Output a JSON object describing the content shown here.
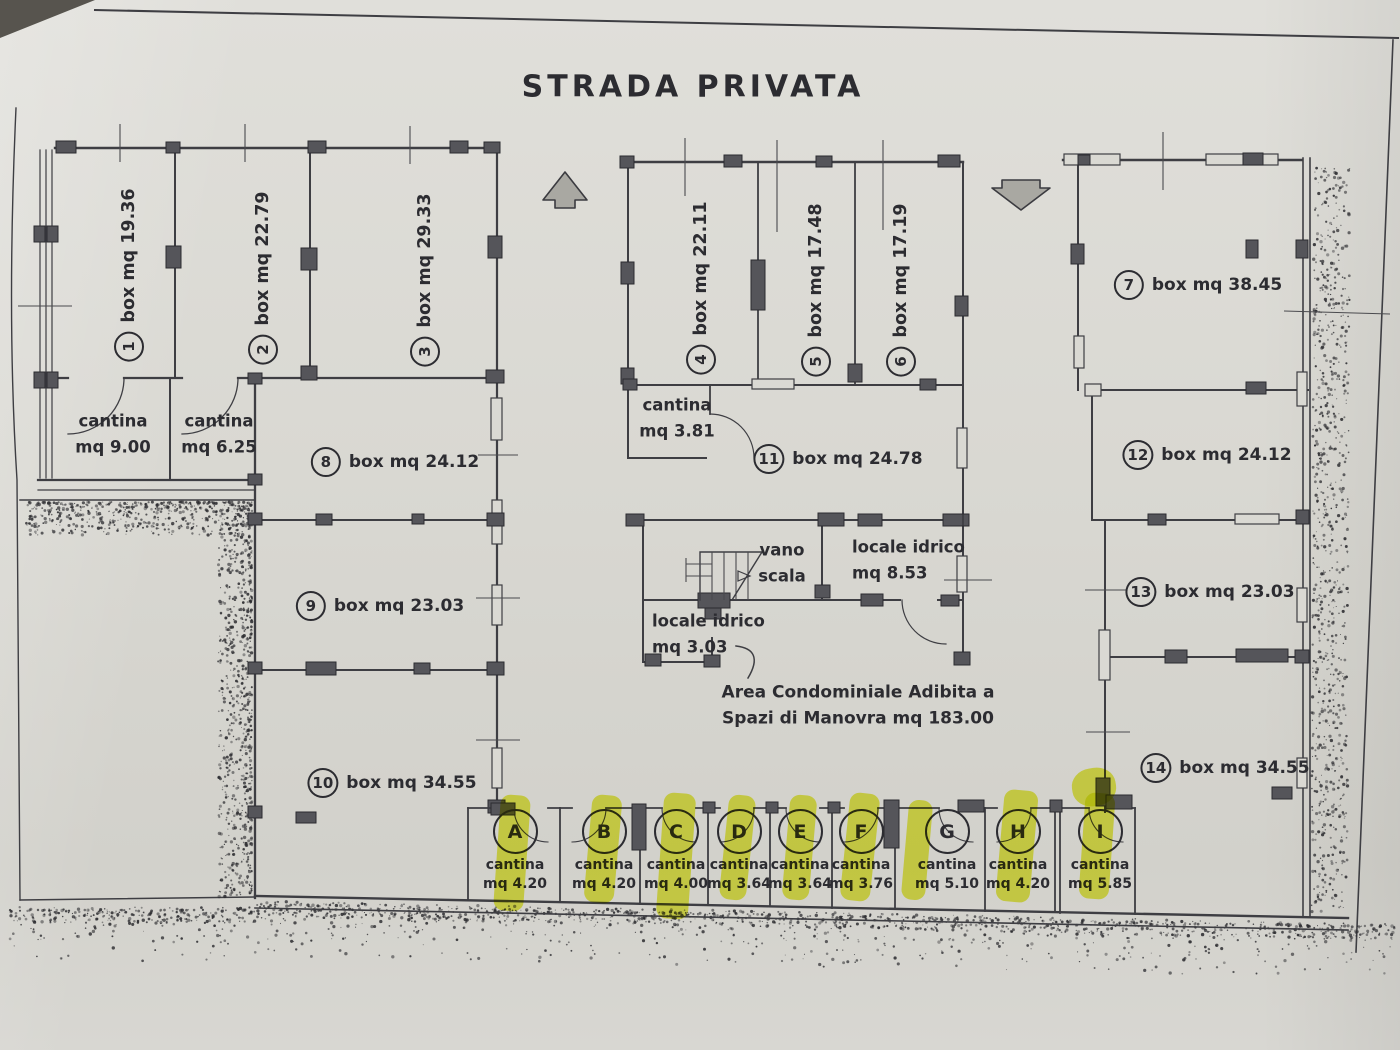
{
  "title": "STRADA PRIVATA",
  "left_wing": {
    "box1": {
      "num": "1",
      "label": "box mq 19.36"
    },
    "box2": {
      "num": "2",
      "label": "box mq 22.79"
    },
    "box3": {
      "num": "3",
      "label": "box mq 29.33"
    },
    "cantina_a": {
      "line1": "cantina",
      "line2": "mq 9.00"
    },
    "cantina_b": {
      "line1": "cantina",
      "line2": "mq 6.25"
    },
    "box8": {
      "num": "8",
      "label": "box mq 24.12"
    },
    "box9": {
      "num": "9",
      "label": "box mq 23.03"
    },
    "box10": {
      "num": "10",
      "label": "box mq 34.55"
    }
  },
  "center_wing": {
    "box4": {
      "num": "4",
      "label": "box mq 22.11"
    },
    "box5": {
      "num": "5",
      "label": "box mq 17.48"
    },
    "box6": {
      "num": "6",
      "label": "box mq 17.19"
    },
    "cantina": {
      "line1": "cantina",
      "line2": "mq 3.81"
    },
    "box11": {
      "num": "11",
      "label": "box mq 24.78"
    },
    "vano_scala": {
      "line1": "vano",
      "line2": "scala"
    },
    "locale_idrico_1": {
      "line1": "locale idrico",
      "line2": "mq 8.53"
    },
    "locale_idrico_2": {
      "line1": "locale idrico",
      "line2": "mq 3.03"
    },
    "area_note": {
      "line1": "Area Condominiale Adibita a",
      "line2": "Spazi di Manovra mq 183.00"
    }
  },
  "right_wing": {
    "box7": {
      "num": "7",
      "label": "box mq 38.45"
    },
    "box12": {
      "num": "12",
      "label": "box mq 24.12"
    },
    "box13": {
      "num": "13",
      "label": "box mq 23.03"
    },
    "box14": {
      "num": "14",
      "label": "box mq 34.55"
    }
  },
  "cellars": [
    {
      "letter": "A",
      "line1": "cantina",
      "line2": "mq 4.20"
    },
    {
      "letter": "B",
      "line1": "cantina",
      "line2": "mq 4.20"
    },
    {
      "letter": "C",
      "line1": "cantina",
      "line2": "mq 4.00"
    },
    {
      "letter": "D",
      "line1": "cantina",
      "line2": "mq 3.64"
    },
    {
      "letter": "E",
      "line1": "cantina",
      "line2": "mq 3.64"
    },
    {
      "letter": "F",
      "line1": "cantina",
      "line2": "mq 3.76"
    },
    {
      "letter": "G",
      "line1": "cantina",
      "line2": "mq 5.10"
    },
    {
      "letter": "H",
      "line1": "cantina",
      "line2": "mq 4.20"
    },
    {
      "letter": "I",
      "line1": "cantina",
      "line2": "mq 5.85"
    }
  ],
  "colors": {
    "highlighter": "#e6ee28",
    "ink": "#2c2c31",
    "paper": "#d9d8d2"
  }
}
